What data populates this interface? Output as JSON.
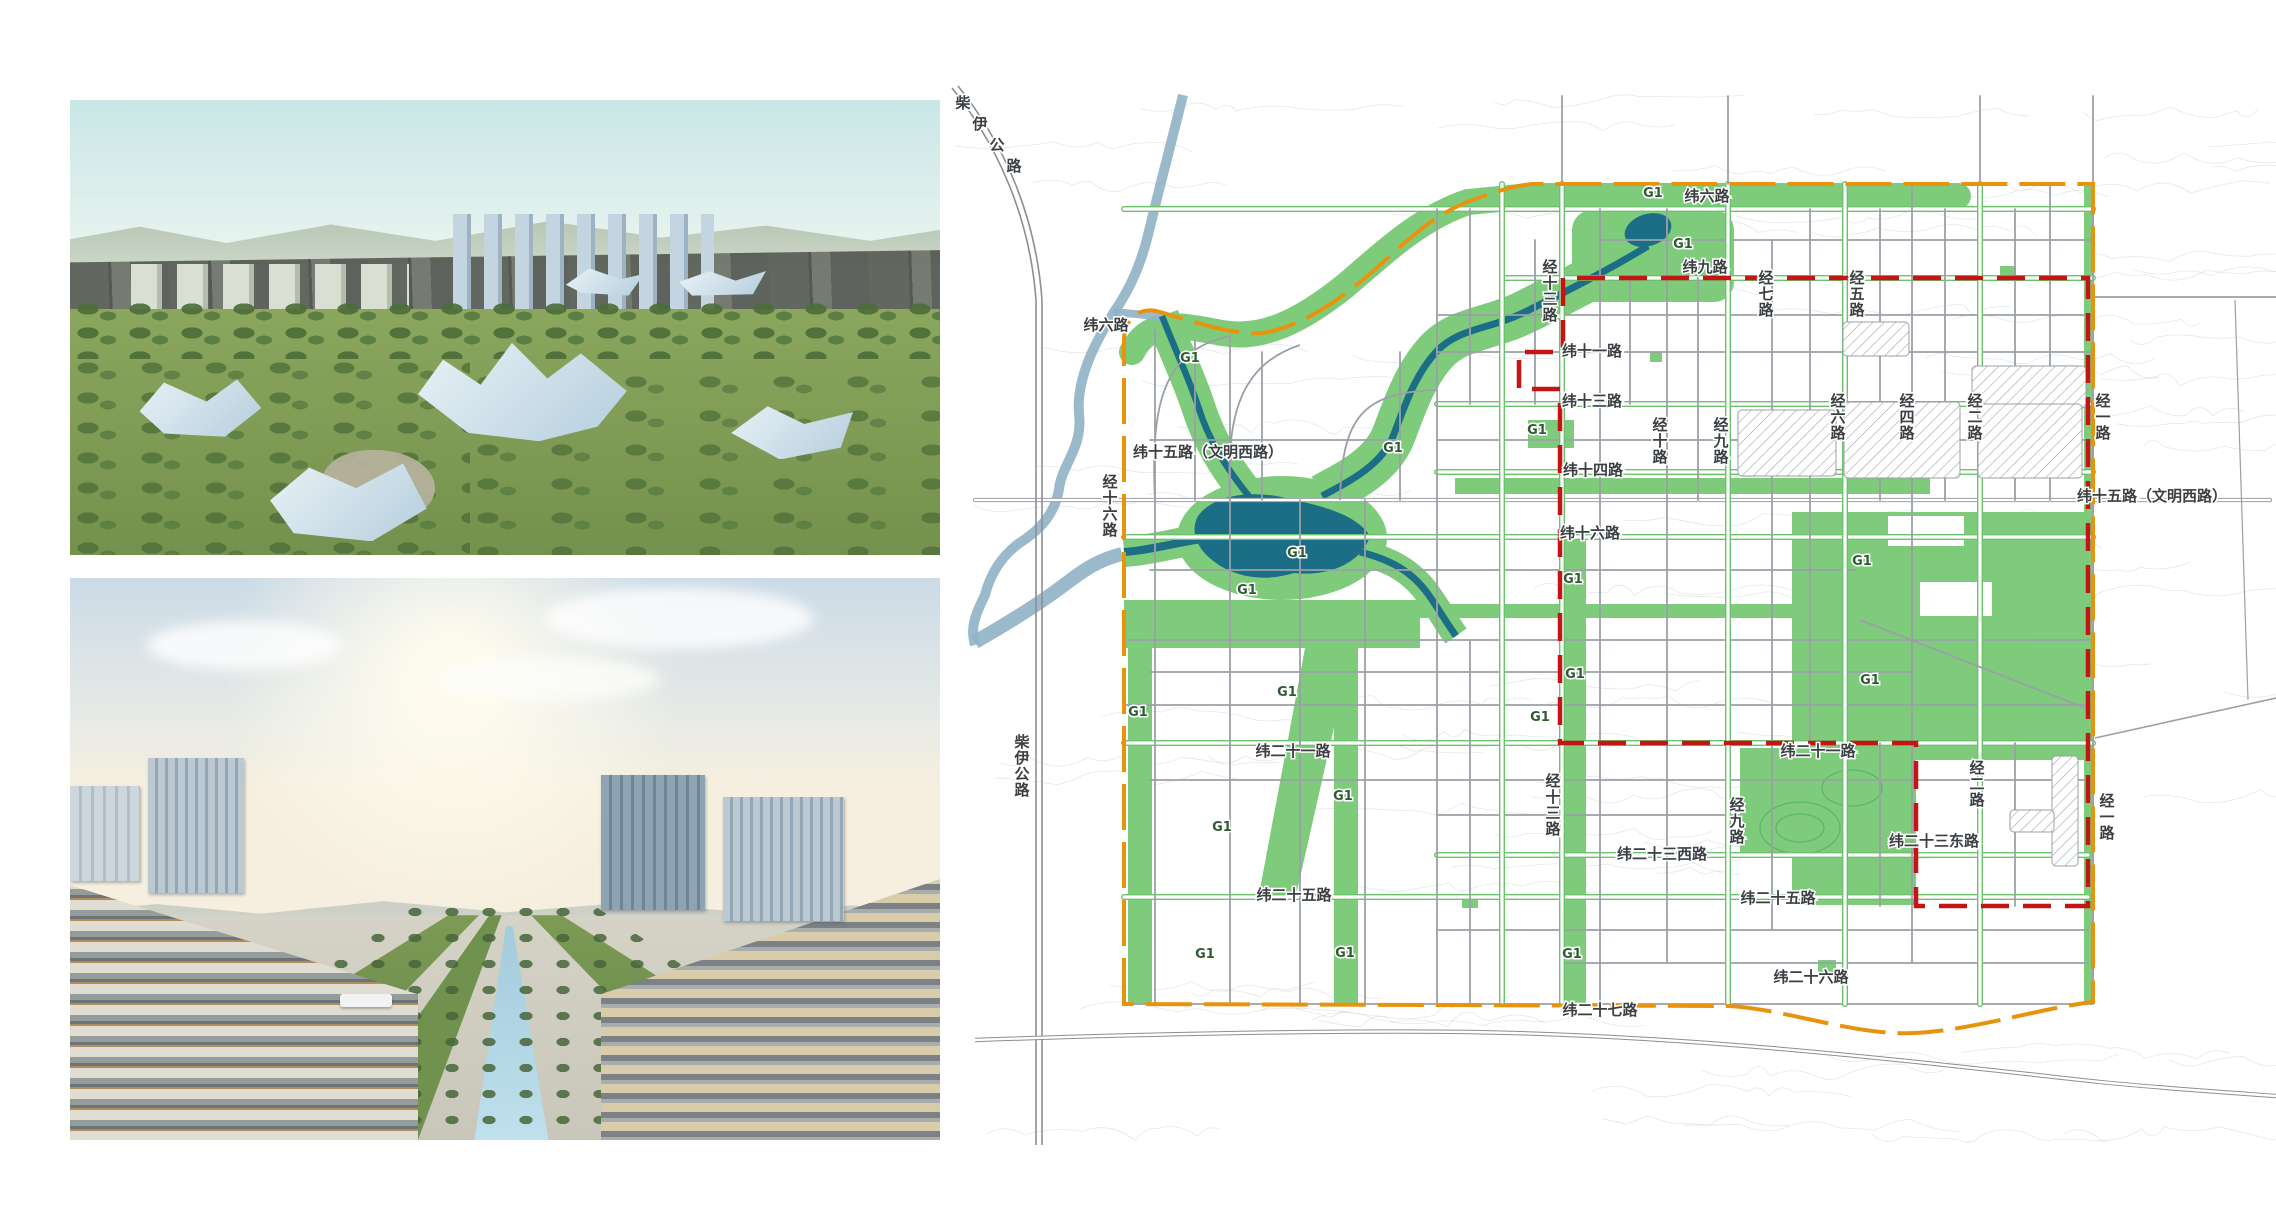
{
  "map": {
    "colors": {
      "green": "#7ECB7C",
      "green_line": "#6CC26C",
      "hill_contour": "#57B469",
      "water": "#1B6E86",
      "river_outside": "#8FB3C7",
      "boundary_orange": "#E8930E",
      "boundary_red": "#C41414",
      "road": "#9AA0A6",
      "contour": "#CCD2D8",
      "label": "#3C4043",
      "g1": "#2F5B33"
    },
    "g1": {
      "text": "G1",
      "positions": [
        [
          1190,
          362
        ],
        [
          1393,
          452
        ],
        [
          1653,
          197
        ],
        [
          1683,
          248
        ],
        [
          1537,
          434
        ],
        [
          1297,
          557
        ],
        [
          1247,
          594
        ],
        [
          1287,
          696
        ],
        [
          1573,
          583
        ],
        [
          1862,
          565
        ],
        [
          1870,
          684
        ],
        [
          1575,
          678
        ],
        [
          1540,
          721
        ],
        [
          1138,
          716
        ],
        [
          1222,
          831
        ],
        [
          1343,
          800
        ],
        [
          1205,
          958
        ],
        [
          1345,
          957
        ],
        [
          1572,
          958
        ]
      ]
    },
    "labels": [
      {
        "text": "柴伊公路",
        "x": 963,
        "y": 108,
        "mode": "d"
      },
      {
        "text": "纬六路",
        "x": 1106,
        "y": 330,
        "mode": "h"
      },
      {
        "text": "纬十五路（文明西路）",
        "x": 1208,
        "y": 457,
        "mode": "h"
      },
      {
        "text": "经十六路",
        "x": 1110,
        "y": 487,
        "mode": "v"
      },
      {
        "text": "柴伊公路",
        "x": 1022,
        "y": 747,
        "mode": "v"
      },
      {
        "text": "纬六路",
        "x": 1707,
        "y": 201,
        "mode": "h"
      },
      {
        "text": "纬九路",
        "x": 1705,
        "y": 272,
        "mode": "h"
      },
      {
        "text": "经十三路",
        "x": 1550,
        "y": 272,
        "mode": "v"
      },
      {
        "text": "纬十一路",
        "x": 1592,
        "y": 356,
        "mode": "h"
      },
      {
        "text": "经七路",
        "x": 1766,
        "y": 283,
        "mode": "v"
      },
      {
        "text": "经五路",
        "x": 1857,
        "y": 283,
        "mode": "v"
      },
      {
        "text": "纬十三路",
        "x": 1592,
        "y": 406,
        "mode": "h"
      },
      {
        "text": "纬十四路",
        "x": 1593,
        "y": 475,
        "mode": "h"
      },
      {
        "text": "经十路",
        "x": 1660,
        "y": 430,
        "mode": "v"
      },
      {
        "text": "经九路",
        "x": 1721,
        "y": 430,
        "mode": "v"
      },
      {
        "text": "经六路",
        "x": 1838,
        "y": 406,
        "mode": "v"
      },
      {
        "text": "经四路",
        "x": 1907,
        "y": 406,
        "mode": "v"
      },
      {
        "text": "经二路",
        "x": 1975,
        "y": 406,
        "mode": "v"
      },
      {
        "text": "经一路",
        "x": 2103,
        "y": 406,
        "mode": "v"
      },
      {
        "text": "纬十六路",
        "x": 1590,
        "y": 538,
        "mode": "h"
      },
      {
        "text": "纬十五路（文明西路）",
        "x": 2152,
        "y": 501,
        "mode": "h"
      },
      {
        "text": "纬二十一路",
        "x": 1293,
        "y": 756,
        "mode": "h"
      },
      {
        "text": "纬二十一路",
        "x": 1818,
        "y": 756,
        "mode": "h"
      },
      {
        "text": "经十三路",
        "x": 1553,
        "y": 786,
        "mode": "v"
      },
      {
        "text": "经九路",
        "x": 1737,
        "y": 810,
        "mode": "v"
      },
      {
        "text": "纬二十三西路",
        "x": 1662,
        "y": 859,
        "mode": "h"
      },
      {
        "text": "纬二十三东路",
        "x": 1934,
        "y": 846,
        "mode": "h"
      },
      {
        "text": "经二路",
        "x": 1977,
        "y": 773,
        "mode": "v"
      },
      {
        "text": "经一路",
        "x": 2107,
        "y": 806,
        "mode": "v"
      },
      {
        "text": "纬二十五路",
        "x": 1294,
        "y": 900,
        "mode": "h"
      },
      {
        "text": "纬二十五路",
        "x": 1778,
        "y": 903,
        "mode": "h"
      },
      {
        "text": "纬二十六路",
        "x": 1811,
        "y": 982,
        "mode": "h"
      },
      {
        "text": "纬二十七路",
        "x": 1600,
        "y": 1015,
        "mode": "h"
      }
    ]
  }
}
